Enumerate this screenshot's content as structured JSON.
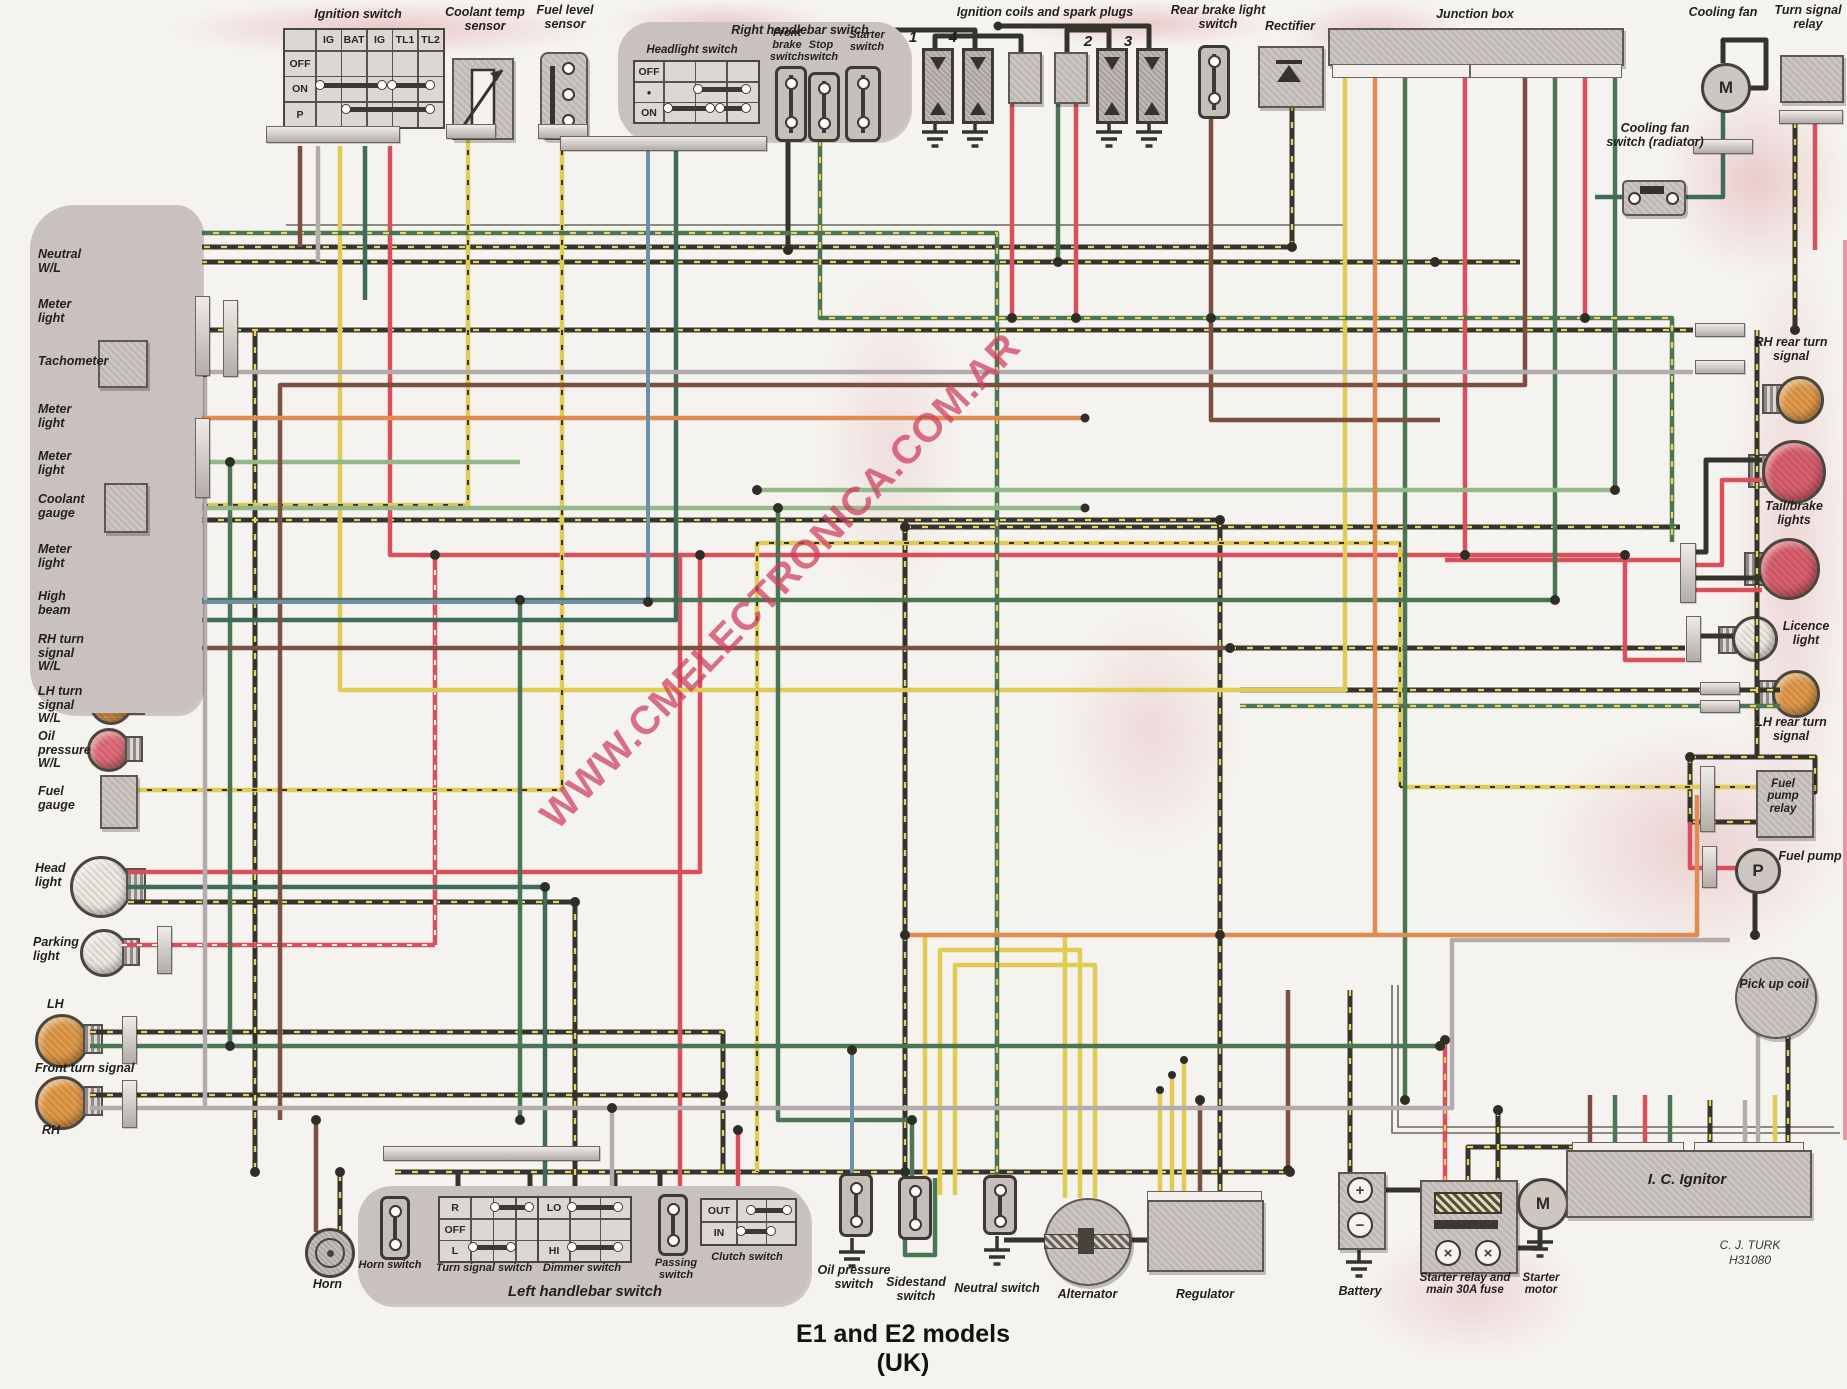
{
  "title": "E1 and E2 models (UK)",
  "watermark": "WWW.CMELECTRONICA.COM.AR",
  "credit": {
    "name": "C. J. TURK",
    "code": "H31080"
  },
  "top": {
    "ignition_switch": {
      "label": "Ignition switch",
      "cols": [
        "IG",
        "BAT",
        "IG",
        "TL1",
        "TL2"
      ],
      "rows": [
        "OFF",
        "ON",
        "P"
      ]
    },
    "coolant_temp_sensor": {
      "label": "Coolant temp sensor"
    },
    "fuel_level_sensor": {
      "label": "Fuel level sensor"
    },
    "right_handlebar": {
      "label": "Right handlebar switch",
      "headlight_switch": {
        "label": "Headlight switch",
        "rows": [
          "OFF",
          "●",
          "ON"
        ]
      },
      "front_brake_switch": {
        "label": "Front brake switch"
      },
      "stop_switch": {
        "label": "Stop switch"
      },
      "starter_switch": {
        "label": "Starter switch"
      }
    },
    "coils": {
      "label": "Ignition coils and spark plugs",
      "cylinders": [
        "1",
        "4",
        "2",
        "3"
      ]
    },
    "rear_brake_light_switch": {
      "label": "Rear brake light switch"
    },
    "rectifier": {
      "label": "Rectifier"
    },
    "junction_box": {
      "label": "Junction box"
    },
    "cooling_fan": {
      "label": "Cooling fan",
      "motor": "M"
    },
    "turn_signal_relay": {
      "label": "Turn signal relay"
    },
    "cooling_fan_switch": {
      "label": "Cooling fan switch (radiator)"
    }
  },
  "panel": {
    "items": [
      {
        "label": "Neutral W/L"
      },
      {
        "label": "Meter light"
      },
      {
        "label": "Tachometer"
      },
      {
        "label": "Meter light"
      },
      {
        "label": "Meter light"
      },
      {
        "label": "Coolant gauge"
      },
      {
        "label": "Meter light"
      },
      {
        "label": "High beam"
      },
      {
        "label": "RH turn signal W/L"
      },
      {
        "label": "LH turn signal W/L"
      },
      {
        "label": "Oil pressure W/L"
      },
      {
        "label": "Fuel gauge"
      }
    ]
  },
  "front_lights": {
    "head_light": "Head light",
    "parking_light": "Parking light",
    "lh": "LH",
    "front_turn_signal": "Front turn signal",
    "rh": "RH"
  },
  "bottom": {
    "horn": "Horn",
    "left_handlebar": {
      "label": "Left handlebar switch",
      "horn_switch": "Horn switch",
      "turn_signal_switch": {
        "label": "Turn signal switch",
        "rows": [
          "R",
          "OFF",
          "L"
        ]
      },
      "dimmer_switch": {
        "label": "Dimmer switch",
        "rows": [
          "LO",
          "HI"
        ]
      },
      "passing_switch": "Passing switch",
      "clutch_switch": {
        "label": "Clutch switch",
        "rows": [
          "OUT",
          "IN"
        ]
      }
    },
    "oil_pressure_switch": "Oil pressure switch",
    "sidestand_switch": "Sidestand switch",
    "neutral_switch": "Neutral switch",
    "alternator": "Alternator",
    "regulator": "Regulator",
    "battery": {
      "label": "Battery",
      "plus": "+",
      "minus": "−"
    },
    "starter_relay": "Starter relay and main 30A fuse",
    "starter_motor": {
      "label": "Starter motor",
      "motor": "M"
    },
    "ic_ignitor": "I. C. Ignitor"
  },
  "rear": {
    "rh_rear_turn_signal": "RH rear turn signal",
    "tail_brake_lights": "Tail/brake lights",
    "licence_light": "Licence light",
    "lh_rear_turn_signal": "LH rear turn signal",
    "fuel_pump_relay": "Fuel pump relay",
    "fuel_pump": {
      "label": "Fuel pump",
      "symbol": "P"
    },
    "pick_up_coil": "Pick up coil"
  },
  "colors": {
    "wire_black": "#35342b",
    "wire_yellow": "#e7d35b",
    "wire_red": "#d94f5c",
    "wire_green": "#4c7553",
    "wire_light_green": "#93b98a",
    "wire_brown": "#7d4f41",
    "wire_gray": "#b3abac",
    "wire_orange": "#e28b4e",
    "wire_blue": "#6f8fa8",
    "wire_teal": "#3f6a5c",
    "lamp_green": "#6aa26d",
    "lamp_white": "#edeae3",
    "lamp_blue": "#8098ba",
    "lamp_amber": "#e09a4a",
    "lamp_red": "#e06e7a",
    "watermark_red": "#cd3c5c",
    "paper": "#f5f3ef"
  }
}
